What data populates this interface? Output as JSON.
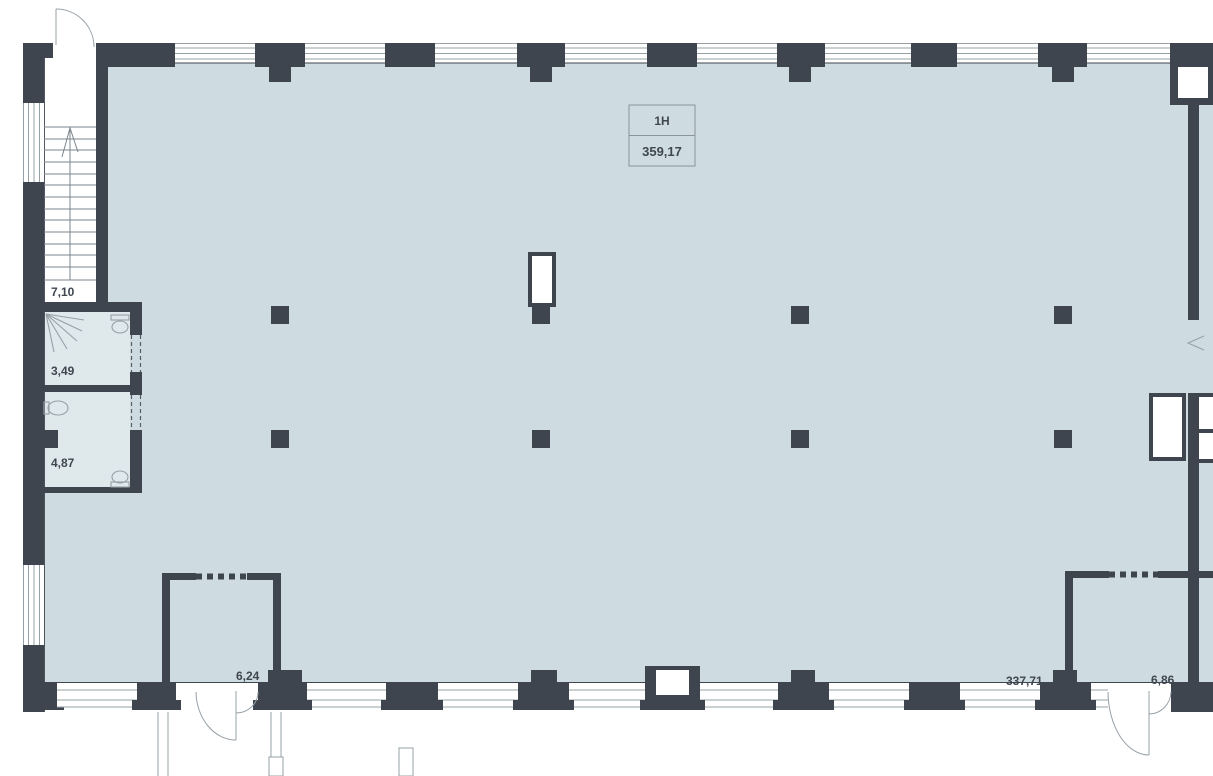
{
  "plan": {
    "type": "commercial-floor-plan",
    "unit": {
      "name": "1H",
      "area": "359,17"
    },
    "rooms": [
      {
        "id": "stairwell",
        "area_label": "7,10"
      },
      {
        "id": "wc-top",
        "area_label": "3,49"
      },
      {
        "id": "wc-bottom",
        "area_label": "4,87"
      },
      {
        "id": "vestibule-left",
        "area_label": "6,24"
      },
      {
        "id": "main-hall",
        "area_label": "337,71"
      },
      {
        "id": "vestibule-right",
        "area_label": "6,86"
      }
    ],
    "fixtures": [
      "shower-head",
      "toilet",
      "sink",
      "toilet"
    ],
    "features": [
      "stairs-with-up-arrow",
      "entrance-double-door-left",
      "entrance-double-door-right",
      "window-strips",
      "structural-columns",
      "ventilation-shafts"
    ],
    "colors": {
      "wall": "#3e454f",
      "floor": "#cedce2",
      "wet_room_floor": "#dfe8eb",
      "line": "#97a0a7",
      "text": "#3f4650",
      "box_border": "#8b949b",
      "background": "#ffffff"
    }
  }
}
